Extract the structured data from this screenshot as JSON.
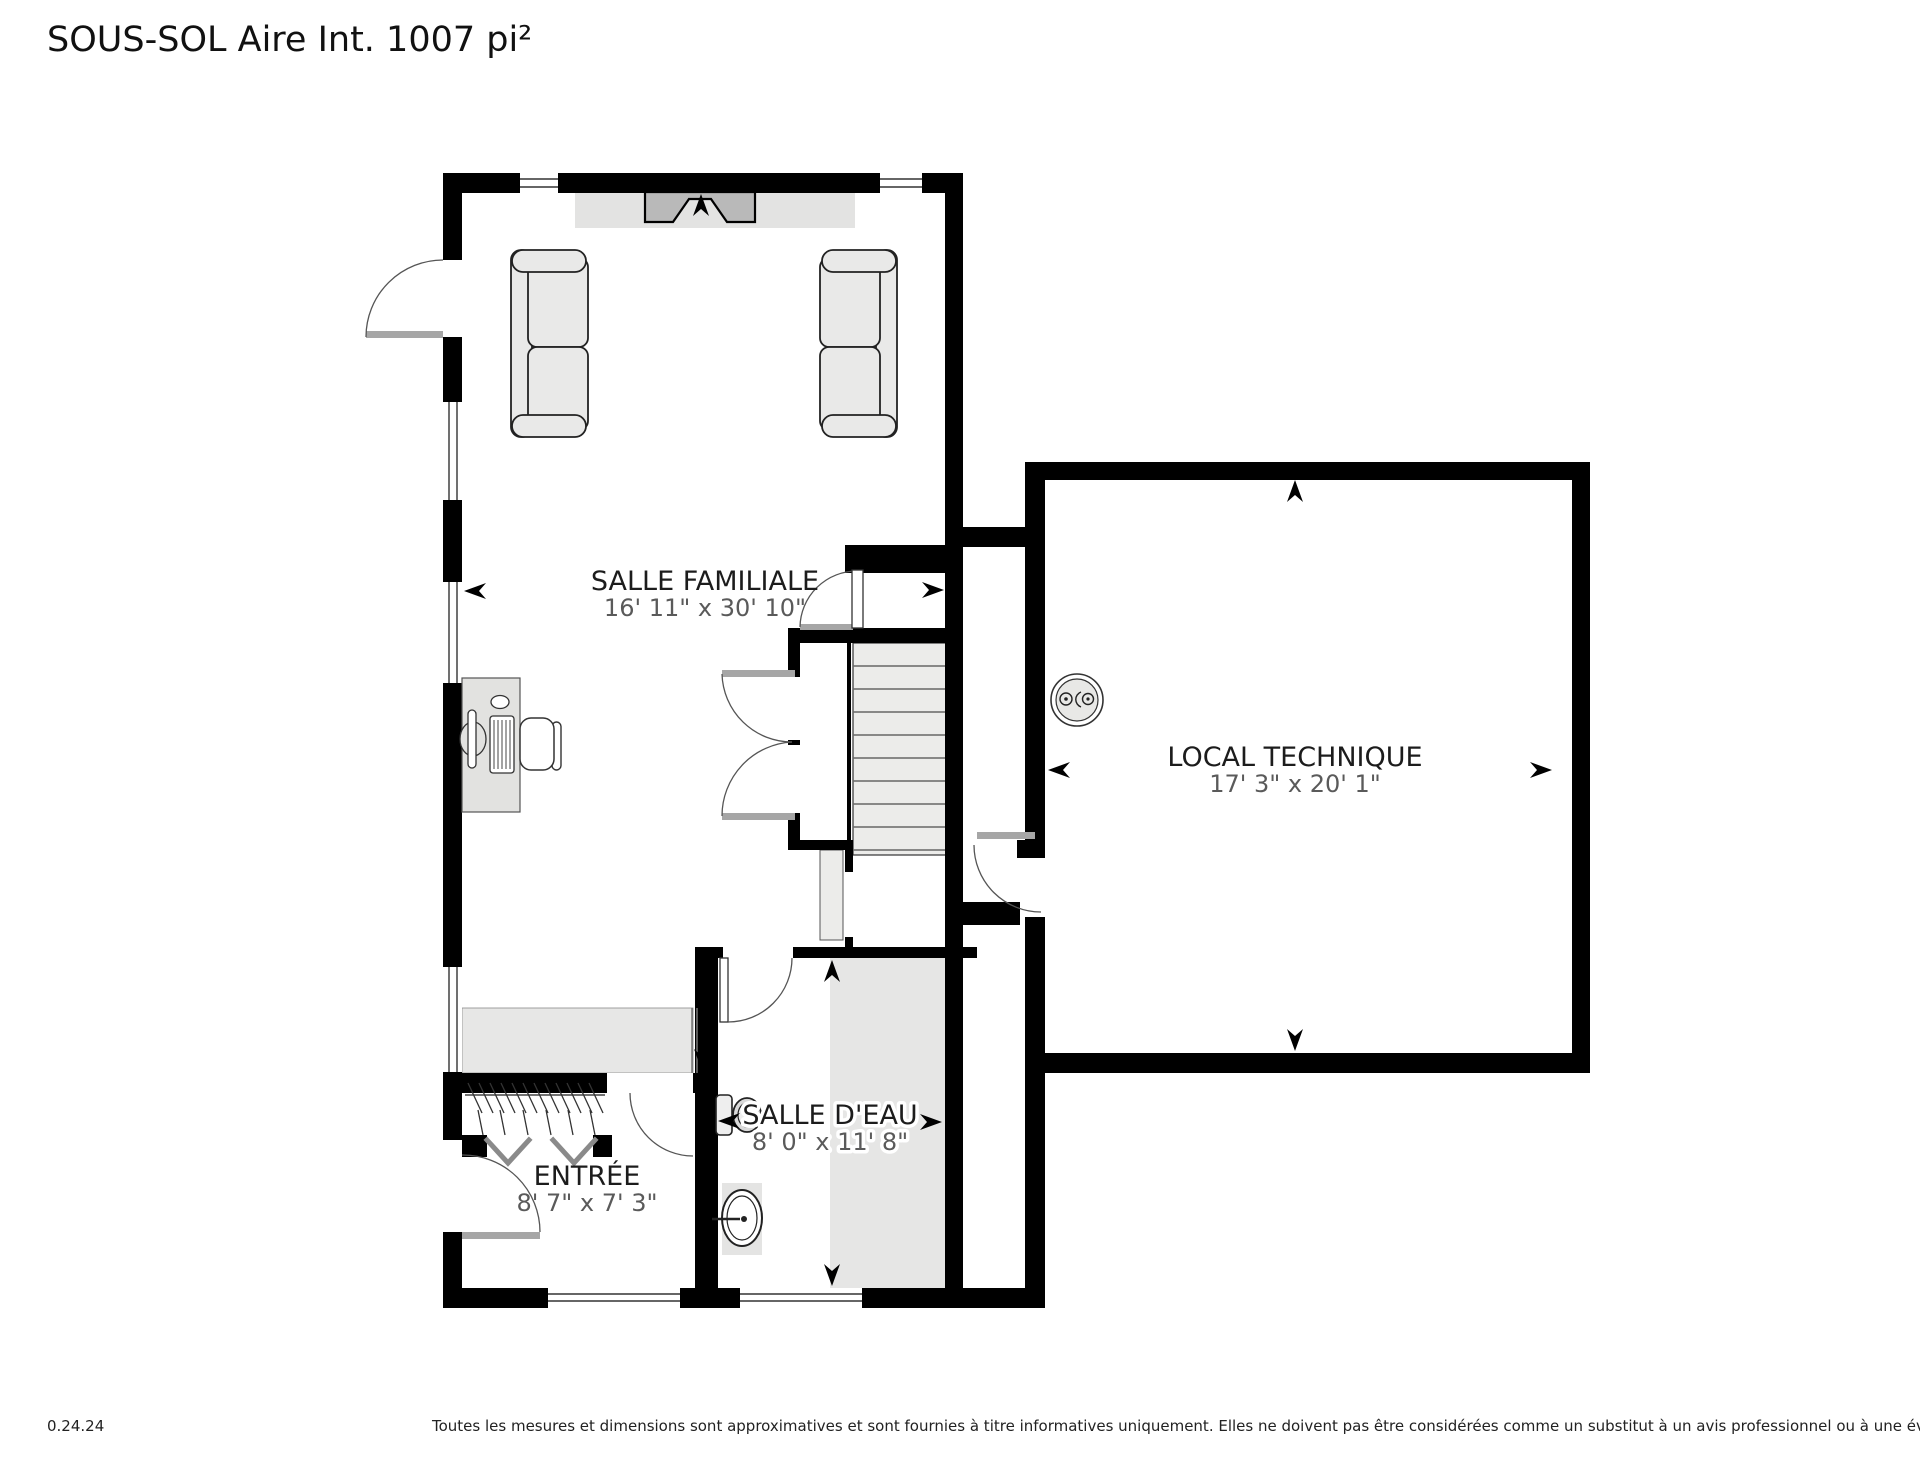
{
  "title": "SOUS-SOL Aire Int. 1007 pi²",
  "footer": {
    "version": "0.24.24",
    "disclaimer": "Toutes les mesures et dimensions sont approximatives et sont fournies à titre informatives uniquement. Elles ne doivent pas être considérées comme un substitut à un avis professionnel ou à une évaluation précise."
  },
  "rooms": [
    {
      "id": "salle-familiale",
      "name": "SALLE FAMILIALE",
      "dims": "16' 11\" x 30' 10\""
    },
    {
      "id": "local-technique",
      "name": "LOCAL TECHNIQUE",
      "dims": "17' 3\" x 20' 1\""
    },
    {
      "id": "entree",
      "name": "ENTRÉE",
      "dims": "8' 7\" x 7' 3\""
    },
    {
      "id": "salle-deau",
      "name": "SALLE D'EAU",
      "dims": "8' 0\" x 11' 8\""
    }
  ],
  "colors": {
    "wall": "#000000",
    "floor_shade": "#e7e7e6",
    "fireplace": "#b9b9b9",
    "dims_text": "#5a5a5a"
  }
}
